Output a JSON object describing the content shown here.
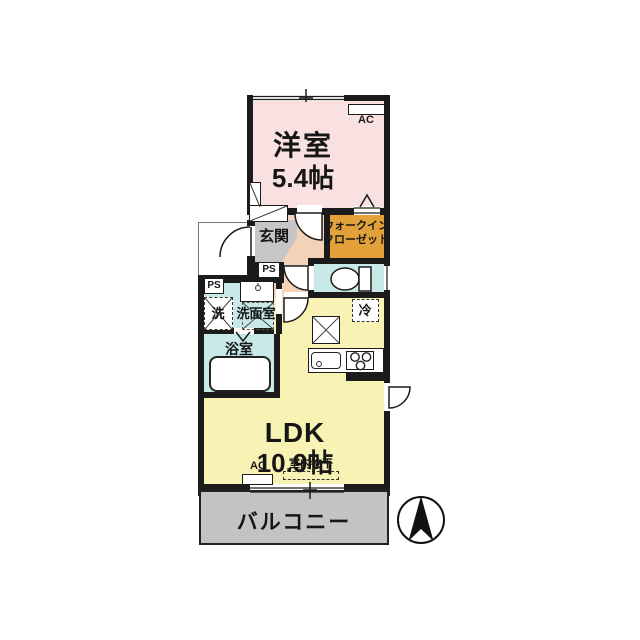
{
  "rooms": {
    "western": {
      "name": "洋室",
      "size": "5.4帖"
    },
    "wic": {
      "line1": "ウォークイン",
      "line2": "クローゼット"
    },
    "genkan": {
      "name": "玄関"
    },
    "washroom": {
      "name": "洗面室"
    },
    "washer": {
      "name": "洗"
    },
    "bath": {
      "name": "浴室"
    },
    "fridge": {
      "name": "冷"
    },
    "ldk": {
      "name": "LDK",
      "size": "10.9帖"
    },
    "balcony": {
      "name": "バルコニー"
    }
  },
  "annotations": {
    "ac": "AC",
    "ps": "PS",
    "indoor_drying": "室内物干"
  },
  "icons": {
    "compass": "north-arrow-icon"
  },
  "colors": {
    "wall": "#1b1b1b",
    "western": "#f9e1e1",
    "ldk": "#f8f3b4",
    "hall": "#f3d2b7",
    "genkan": "#c6c6c8",
    "wic": "#e2a239",
    "wet": "#c9e9e9",
    "balcony": "#c3c3c3",
    "outline": "#222222"
  }
}
